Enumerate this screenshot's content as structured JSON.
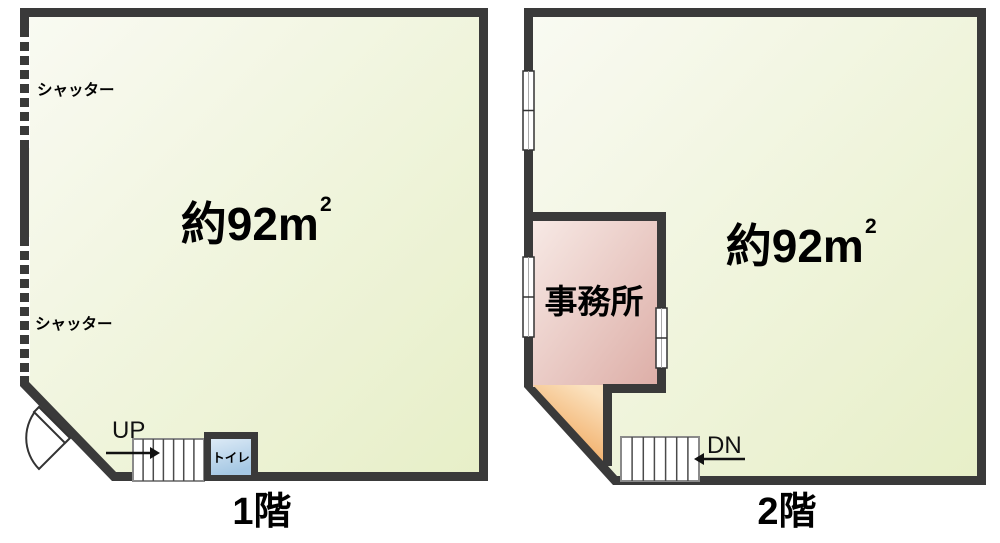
{
  "floor1": {
    "floor_label": "1階",
    "area_value": "約92m",
    "area_superscript": "2",
    "shutter_upper_label": "シャッター",
    "shutter_lower_label": "シャッター",
    "stairs_direction_label": "UP",
    "toilet_label": "トイレ"
  },
  "floor2": {
    "floor_label": "2階",
    "area_value": "約92m",
    "area_superscript": "2",
    "office_label": "事務所",
    "stairs_direction_label": "DN"
  },
  "colors": {
    "wall": "#3a3a3a",
    "room_fill_light": "#f9faf2",
    "room_fill_dark": "#e7efc8",
    "office_fill_light": "#f7e9e5",
    "office_fill_dark": "#ddaea7",
    "stairwell_orange_light": "#fbe2bf",
    "stairwell_orange_dark": "#ee9b48",
    "toilet_fill_light": "#dceaf6",
    "toilet_fill_dark": "#a6c8e4",
    "stair_outline": "#8a8a8a",
    "text": "#000000"
  }
}
